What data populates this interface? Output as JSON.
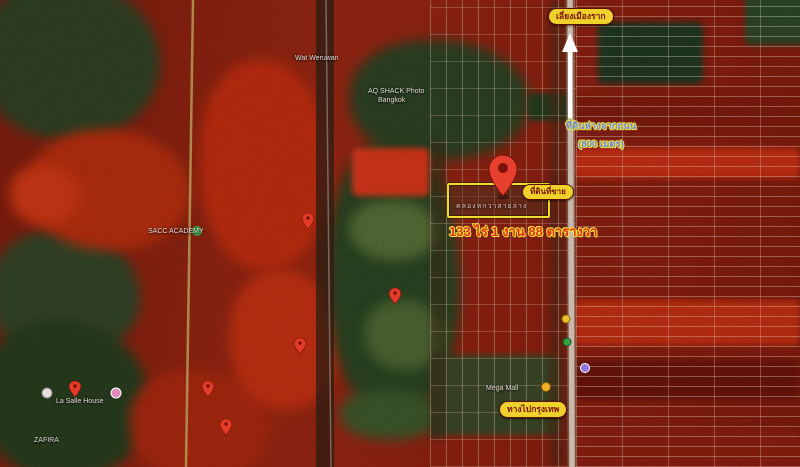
{
  "map": {
    "kind": "satellite-false-color",
    "annotations": {
      "top_road_label": "เลี่ยงเมืองราก",
      "setback_line1": "ที่ดินห่างจากถนน",
      "setback_line2": "(800 เมตร)",
      "sale_tag": "ที่ดินที่ขาย",
      "canal_label": "คลองหกวาสายล่าง",
      "area_label": "133 ไร่ 1 งาน 88 ตารางวา",
      "bangkok_label": "ทางไปกรุงเทพ"
    },
    "pois": [
      {
        "label": "Wat Weruwan"
      },
      {
        "label": "AQ SHACK Photo"
      },
      {
        "label": "Bangkok"
      },
      {
        "label": "SACC ACADEMY"
      },
      {
        "label": "La Salle House"
      },
      {
        "label": "ZAFIRA"
      },
      {
        "label": "Mega Mall"
      }
    ],
    "colors": {
      "label_bg": "#eed22b",
      "label_text": "#7a1208",
      "setback_text": "#6b85e8",
      "outline": "#f0e23a",
      "area_text": "#e03318",
      "plot_outline": "#eede2c",
      "pin_red": "#e8402e",
      "highway": "#ded8c8"
    }
  }
}
